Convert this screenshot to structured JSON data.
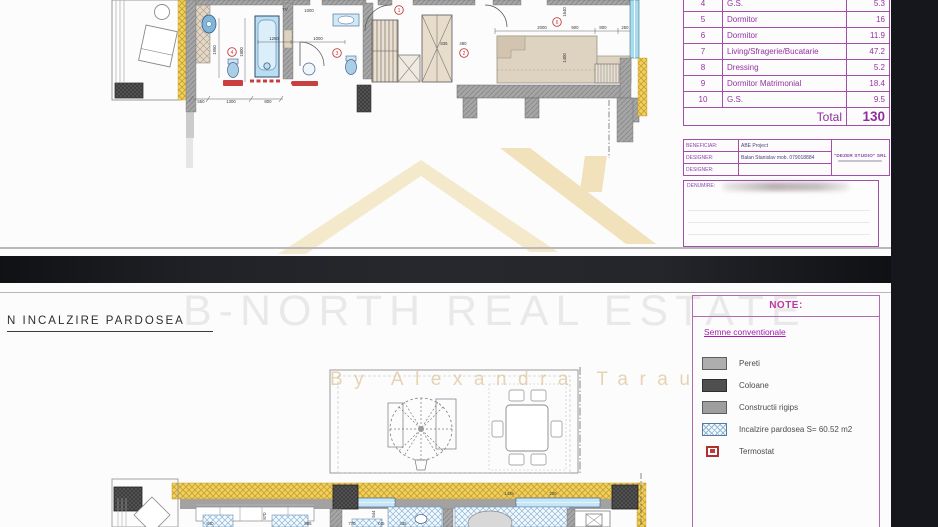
{
  "page1": {
    "area_table": {
      "rows": [
        {
          "no": "4",
          "name": "G.S.",
          "area": "5.3"
        },
        {
          "no": "5",
          "name": "Dormitor",
          "area": "16"
        },
        {
          "no": "6",
          "name": "Dormitor",
          "area": "11.9"
        },
        {
          "no": "7",
          "name": "Living/Sfragerie/Bucatarie",
          "area": "47.2"
        },
        {
          "no": "8",
          "name": "Dressing",
          "area": "5.2"
        },
        {
          "no": "9",
          "name": "Dormitor Matrimonial",
          "area": "18.4"
        },
        {
          "no": "10",
          "name": "G.S.",
          "area": "9.5"
        }
      ],
      "total_label": "Total",
      "total_value": "130"
    },
    "title_block": {
      "rows": [
        {
          "label": "BENEFICIAR:",
          "value": "ABE Project"
        },
        {
          "label": "DESIGNER:",
          "value": "Balan Stanislav   mob. 079018884"
        },
        {
          "label": "DESIGNER:",
          "value": ""
        }
      ],
      "company": "\"DEZER STUDIO\" SRL"
    },
    "stamp_label": "DENUMIRE:",
    "plan": {
      "labels": [
        {
          "t": "550",
          "x": 106,
          "y": 103
        },
        {
          "t": "1300",
          "x": 136,
          "y": 103
        },
        {
          "t": "800",
          "x": 173,
          "y": 103
        },
        {
          "t": "1950",
          "x": 121,
          "y": 50,
          "r": 1
        },
        {
          "t": "1800",
          "x": 148,
          "y": 52,
          "r": 1
        },
        {
          "t": "1250",
          "x": 179,
          "y": 40
        },
        {
          "t": "1000",
          "x": 223,
          "y": 40
        },
        {
          "t": "1000",
          "x": 214,
          "y": 12
        },
        {
          "t": "TV",
          "x": 190,
          "y": 11
        },
        {
          "t": "836",
          "x": 349,
          "y": 45
        },
        {
          "t": "480",
          "x": 368,
          "y": 45
        },
        {
          "t": "2000",
          "x": 447,
          "y": 29
        },
        {
          "t": "900",
          "x": 480,
          "y": 29
        },
        {
          "t": "800",
          "x": 508,
          "y": 29
        },
        {
          "t": "250",
          "x": 530,
          "y": 29
        },
        {
          "t": "1640",
          "x": 471,
          "y": 12,
          "r": 1
        },
        {
          "t": "1400",
          "x": 471,
          "y": 58,
          "r": 1
        }
      ],
      "markers": [
        {
          "n": "1",
          "x": 304,
          "y": 10
        },
        {
          "n": "2",
          "x": 369,
          "y": 53
        },
        {
          "n": "3",
          "x": 242,
          "y": 53
        },
        {
          "n": "4",
          "x": 137,
          "y": 52
        },
        {
          "n": "6",
          "x": 462,
          "y": 22
        }
      ]
    }
  },
  "page2": {
    "heading": "N INCALZIRE PARDOSEA",
    "watermark_line1": "B-NORTH REAL ESTATE",
    "watermark_line2": "By Alexandra Tarau",
    "note_box": {
      "title": "NOTE:",
      "subtitle": "Semne conventionale",
      "legend": [
        {
          "swatch": "pereti",
          "label": "Pereti"
        },
        {
          "swatch": "coloane",
          "label": "Coloane"
        },
        {
          "swatch": "rigips",
          "label": "Constructii rigips"
        },
        {
          "swatch": "incalzire",
          "label": "Incalzire pardosea S= 60.52 m2"
        },
        {
          "swatch": "termostat",
          "label": "Termostat"
        }
      ]
    },
    "plan": {
      "labels": [
        {
          "t": "1435",
          "x": 509,
          "y": 212
        },
        {
          "t": "200",
          "x": 553,
          "y": 212
        },
        {
          "t": "840",
          "x": 210,
          "y": 242
        },
        {
          "t": "885",
          "x": 308,
          "y": 242
        },
        {
          "t": "770",
          "x": 352,
          "y": 242
        },
        {
          "t": "745",
          "x": 381,
          "y": 242
        },
        {
          "t": "335",
          "x": 403,
          "y": 242
        },
        {
          "t": "870",
          "x": 266,
          "y": 233,
          "r": 1
        },
        {
          "t": "544",
          "x": 375,
          "y": 231,
          "r": 1
        }
      ]
    }
  },
  "colors": {
    "accent_purple": "#a14fa8",
    "table_text": "#9333a0",
    "note_magenta": "#bd37a0",
    "wall_yellow": "#f0d061",
    "heating_blue": "#8fb8d8",
    "marker_red": "#c23b3b",
    "divider_black": "#1d1f24"
  }
}
